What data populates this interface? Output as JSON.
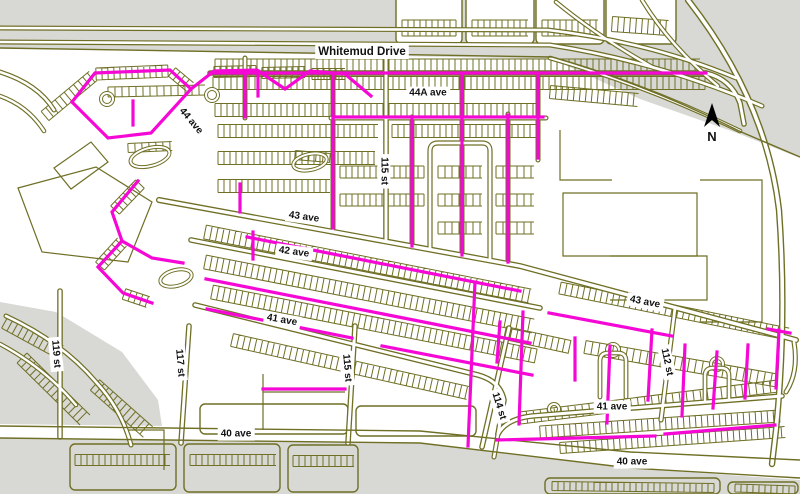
{
  "map": {
    "width": 800,
    "height": 494,
    "colors": {
      "olive": "#6f6f26",
      "magenta": "#f507d5",
      "gray": "#d8d8d4",
      "road_fill": "#ffffff",
      "label_text": "#111111",
      "label_bg": "#ffffff",
      "north": "#000000",
      "background": "#ffffff"
    },
    "gray_areas": [
      "M0,0 L800,0 L800,158 L737,133 L640,99 L552,59 L0,48 Z",
      "M0,302 L56,312 L122,352 L158,400 L162,426 L0,424 Z",
      "M0,438 L420,443 L630,468 L800,480 L800,494 L0,494 Z"
    ],
    "white_blocks": [
      {
        "x": 396,
        "y": -8,
        "w": 66,
        "h": 52
      },
      {
        "x": 466,
        "y": -8,
        "w": 68,
        "h": 52
      },
      {
        "x": 536,
        "y": -8,
        "w": 68,
        "h": 52
      },
      {
        "x": 606,
        "y": -6,
        "w": 70,
        "h": 50
      },
      {
        "x": 200,
        "y": 404,
        "w": 148,
        "h": 30
      },
      {
        "x": 356,
        "y": 406,
        "w": 120,
        "h": 30
      }
    ],
    "gray_blocks": [
      {
        "x": 70,
        "y": 444,
        "w": 106,
        "h": 46
      },
      {
        "x": 184,
        "y": 444,
        "w": 96,
        "h": 48
      },
      {
        "x": 288,
        "y": 445,
        "w": 70,
        "h": 47
      },
      {
        "x": 545,
        "y": 478,
        "w": 175,
        "h": 16
      },
      {
        "x": 728,
        "y": 482,
        "w": 70,
        "h": 12
      }
    ],
    "parcels": [
      "M563,193 L697,193 L697,256 L563,256 Z",
      "M610,256 L707,256 L707,300 L610,300",
      "M700,180 L762,180 L762,322 L700,322",
      "M560,130 L560,180 L612,180",
      "M18,188 L96,167 L152,202 L128,262 L42,252 Z",
      "M54,168 L91,142 L108,162 L71,189 Z",
      "M128,430 L164,430 L164,470",
      "M263,374 L263,430",
      "M263,392 L345,392"
    ],
    "strips": [
      {
        "x1": 215,
        "y1": 65,
        "x2": 700,
        "y2": 65,
        "w": 12,
        "sp": 6
      },
      {
        "x1": 213,
        "y1": 83,
        "x2": 705,
        "y2": 83,
        "w": 13,
        "sp": 6
      },
      {
        "x1": 215,
        "y1": 110,
        "x2": 540,
        "y2": 110,
        "w": 13,
        "sp": 6
      },
      {
        "x1": 550,
        "y1": 92,
        "x2": 638,
        "y2": 100,
        "w": 13,
        "sp": 6
      },
      {
        "x1": 218,
        "y1": 131,
        "x2": 378,
        "y2": 131,
        "w": 13,
        "sp": 6
      },
      {
        "x1": 392,
        "y1": 131,
        "x2": 540,
        "y2": 131,
        "w": 13,
        "sp": 6
      },
      {
        "x1": 218,
        "y1": 158,
        "x2": 375,
        "y2": 158,
        "w": 13,
        "sp": 6
      },
      {
        "x1": 218,
        "y1": 186,
        "x2": 330,
        "y2": 186,
        "w": 13,
        "sp": 6
      },
      {
        "x1": 340,
        "y1": 172,
        "x2": 424,
        "y2": 172,
        "w": 12,
        "sp": 6
      },
      {
        "x1": 340,
        "y1": 200,
        "x2": 424,
        "y2": 200,
        "w": 12,
        "sp": 6
      },
      {
        "x1": 438,
        "y1": 172,
        "x2": 482,
        "y2": 172,
        "w": 12,
        "sp": 7
      },
      {
        "x1": 438,
        "y1": 200,
        "x2": 482,
        "y2": 200,
        "w": 12,
        "sp": 7
      },
      {
        "x1": 438,
        "y1": 228,
        "x2": 482,
        "y2": 228,
        "w": 12,
        "sp": 7
      },
      {
        "x1": 496,
        "y1": 172,
        "x2": 534,
        "y2": 172,
        "w": 12,
        "sp": 7
      },
      {
        "x1": 496,
        "y1": 200,
        "x2": 534,
        "y2": 200,
        "w": 12,
        "sp": 7
      },
      {
        "x1": 496,
        "y1": 228,
        "x2": 534,
        "y2": 228,
        "w": 12,
        "sp": 7
      },
      {
        "x1": 205,
        "y1": 232,
        "x2": 530,
        "y2": 296,
        "w": 14,
        "sp": 6
      },
      {
        "x1": 205,
        "y1": 262,
        "x2": 533,
        "y2": 326,
        "w": 14,
        "sp": 6
      },
      {
        "x1": 212,
        "y1": 292,
        "x2": 536,
        "y2": 356,
        "w": 14,
        "sp": 6
      },
      {
        "x1": 232,
        "y1": 340,
        "x2": 468,
        "y2": 393,
        "w": 13,
        "sp": 6
      },
      {
        "x1": 560,
        "y1": 288,
        "x2": 788,
        "y2": 334,
        "w": 12,
        "sp": 6
      },
      {
        "x1": 505,
        "y1": 333,
        "x2": 570,
        "y2": 347,
        "w": 13,
        "sp": 6
      },
      {
        "x1": 585,
        "y1": 347,
        "x2": 780,
        "y2": 381,
        "w": 13,
        "sp": 7
      },
      {
        "x1": 540,
        "y1": 432,
        "x2": 780,
        "y2": 416,
        "w": 12,
        "sp": 6
      },
      {
        "x1": 560,
        "y1": 448,
        "x2": 785,
        "y2": 432,
        "w": 11,
        "sp": 6
      },
      {
        "x1": 520,
        "y1": 418,
        "x2": 778,
        "y2": 386,
        "w": 12,
        "sp": 7
      },
      {
        "x1": 75,
        "y1": 460,
        "x2": 170,
        "y2": 460,
        "w": 11,
        "sp": 6
      },
      {
        "x1": 190,
        "y1": 460,
        "x2": 276,
        "y2": 460,
        "w": 11,
        "sp": 6
      },
      {
        "x1": 293,
        "y1": 461,
        "x2": 354,
        "y2": 461,
        "w": 11,
        "sp": 6
      },
      {
        "x1": 552,
        "y1": 486,
        "x2": 714,
        "y2": 488,
        "w": 9,
        "sp": 6
      },
      {
        "x1": 735,
        "y1": 488,
        "x2": 795,
        "y2": 490,
        "w": 8,
        "sp": 6
      },
      {
        "x1": 22,
        "y1": 358,
        "x2": 85,
        "y2": 420,
        "w": 14,
        "sp": 6
      },
      {
        "x1": 95,
        "y1": 385,
        "x2": 148,
        "y2": 432,
        "w": 14,
        "sp": 6
      },
      {
        "x1": 5,
        "y1": 322,
        "x2": 60,
        "y2": 352,
        "w": 14,
        "sp": 6
      },
      {
        "x1": 402,
        "y1": 28,
        "x2": 456,
        "y2": 28,
        "w": 16,
        "sp": 6
      },
      {
        "x1": 472,
        "y1": 28,
        "x2": 528,
        "y2": 28,
        "w": 16,
        "sp": 6
      },
      {
        "x1": 542,
        "y1": 28,
        "x2": 598,
        "y2": 28,
        "w": 16,
        "sp": 6
      },
      {
        "x1": 612,
        "y1": 24,
        "x2": 668,
        "y2": 28,
        "w": 15,
        "sp": 6
      },
      {
        "x1": 45,
        "y1": 116,
        "x2": 93,
        "y2": 76,
        "w": 12,
        "sp": 6
      },
      {
        "x1": 96,
        "y1": 74,
        "x2": 168,
        "y2": 71,
        "w": 12,
        "sp": 6
      },
      {
        "x1": 172,
        "y1": 72,
        "x2": 190,
        "y2": 87,
        "w": 11,
        "sp": 6
      },
      {
        "x1": 214,
        "y1": 72,
        "x2": 256,
        "y2": 71,
        "w": 11,
        "sp": 6
      },
      {
        "x1": 262,
        "y1": 73,
        "x2": 305,
        "y2": 72,
        "w": 11,
        "sp": 6
      },
      {
        "x1": 312,
        "y1": 74,
        "x2": 345,
        "y2": 74,
        "w": 11,
        "sp": 6
      },
      {
        "x1": 115,
        "y1": 210,
        "x2": 140,
        "y2": 184,
        "w": 12,
        "sp": 6
      },
      {
        "x1": 100,
        "y1": 266,
        "x2": 122,
        "y2": 242,
        "w": 12,
        "sp": 6
      },
      {
        "x1": 124,
        "y1": 294,
        "x2": 148,
        "y2": 302,
        "w": 11,
        "sp": 6
      },
      {
        "x1": 108,
        "y1": 92,
        "x2": 205,
        "y2": 90,
        "w": 10,
        "sp": 7
      },
      {
        "x1": 128,
        "y1": 148,
        "x2": 172,
        "y2": 146,
        "w": 9,
        "sp": 7
      },
      {
        "x1": 295,
        "y1": 155,
        "x2": 330,
        "y2": 158,
        "w": 9,
        "sp": 7
      }
    ],
    "rings": [
      {
        "cx": 107,
        "cy": 99,
        "r": 6
      },
      {
        "cx": 212,
        "cy": 95,
        "r": 6
      },
      {
        "cx": 613,
        "cy": 350,
        "r": 6
      },
      {
        "cx": 717,
        "cy": 364,
        "r": 6
      },
      {
        "cx": 554,
        "cy": 409,
        "r": 5
      }
    ],
    "ovals": [
      {
        "cx": 150,
        "cy": 157,
        "rx": 20,
        "ry": 9,
        "rot": -15
      },
      {
        "cx": 310,
        "cy": 162,
        "rx": 17,
        "ry": 8,
        "rot": -12
      },
      {
        "cx": 176,
        "cy": 278,
        "rx": 16,
        "ry": 8,
        "rot": -14
      }
    ],
    "roads": [
      {
        "d": "M0,28 L548,30 Q650,42 736,78",
        "w": 5,
        "f": 2.6
      },
      {
        "d": "M0,42 L550,45 Q660,62 762,106",
        "w": 5,
        "f": 2.6
      },
      {
        "d": "M556,2 Q600,38 654,68",
        "w": 4.6,
        "f": 2.4
      },
      {
        "d": "M642,0 Q670,46 718,86",
        "w": 4.6,
        "f": 2.4
      },
      {
        "d": "M688,0 Q766,100 779,210 Q787,320 776,430 L772,464",
        "w": 6.4,
        "f": 3.6
      },
      {
        "d": "M550,58 Q648,86 740,131",
        "w": 4.6,
        "f": 2.4
      },
      {
        "d": "M210,73 L706,73 Q731,79 740,103 L744,124",
        "w": 5.6,
        "f": 3
      },
      {
        "d": "M386,58 L386,239",
        "w": 5.6,
        "f": 3
      },
      {
        "d": "M245,58 L245,118",
        "w": 5,
        "f": 2.6
      },
      {
        "d": "M333,73 L333,229",
        "w": 5,
        "f": 2.6
      },
      {
        "d": "M412,117 L412,247",
        "w": 5,
        "f": 2.6
      },
      {
        "d": "M462,73 L462,256",
        "w": 5,
        "f": 2.6
      },
      {
        "d": "M508,114 L508,263",
        "w": 5,
        "f": 2.6
      },
      {
        "d": "M538,73 L538,160",
        "w": 5,
        "f": 2.6
      },
      {
        "d": "M331,118 L546,118",
        "w": 5,
        "f": 2.6
      },
      {
        "d": "M430,249 L430,151 Q430,143 438,143 L482,143 Q490,143 490,151 L490,259",
        "w": 5.2,
        "f": 2.8
      },
      {
        "d": "M159,200 L520,266 L796,340",
        "w": 6,
        "f": 3.4
      },
      {
        "d": "M794,342 Q799,372 786,392",
        "w": 5,
        "f": 2.6
      },
      {
        "d": "M191,240 L540,308",
        "w": 5.6,
        "f": 3
      },
      {
        "d": "M195,305 L478,375 Q500,381 504,400 L498,434",
        "w": 5.6,
        "f": 3
      },
      {
        "d": "M498,434 Q506,419 532,416 L782,396",
        "w": 5.6,
        "f": 3
      },
      {
        "d": "M60,291 L60,437",
        "w": 5.6,
        "f": 3
      },
      {
        "d": "M189,326 L181,443",
        "w": 5.6,
        "f": 3
      },
      {
        "d": "M355,326 L348,443",
        "w": 5.6,
        "f": 3
      },
      {
        "d": "M509,328 L482,447",
        "w": 5.6,
        "f": 3
      },
      {
        "d": "M675,308 L661,420",
        "w": 5.2,
        "f": 2.8
      },
      {
        "d": "M498,434 L494,457",
        "w": 5,
        "f": 2.6
      },
      {
        "d": "M600,397 L600,361 Q600,353 608,353 L618,353 Q626,353 626,361 L626,397",
        "w": 4.8,
        "f": 2.5
      },
      {
        "d": "M705,400 L705,376 Q705,368 713,368 L721,368 Q729,368 729,376 L729,400",
        "w": 4.8,
        "f": 2.5
      },
      {
        "d": "M0,72 Q38,84 54,110",
        "w": 5,
        "f": 2.6
      },
      {
        "d": "M0,96 Q28,106 44,131",
        "w": 4.6,
        "f": 2.4
      },
      {
        "d": "M6,316 Q62,342 96,382 Q122,410 131,445",
        "w": 5,
        "f": 2.6
      },
      {
        "d": "M0,344 Q45,368 76,405",
        "w": 4.6,
        "f": 2.4
      }
    ],
    "thin_lines": [
      "M0,48 L552,57",
      "M552,57 Q648,85 739,131 L800,157",
      "M0,426 L420,431 L630,452 L800,460",
      "M0,438 L420,443 L630,468 L800,478"
    ],
    "highlights": [
      "M210,73 L706,73",
      "M245,73 L245,117",
      "M333,75 L333,228",
      "M412,117 L412,246",
      "M462,74 L462,255",
      "M508,115 L508,262",
      "M538,74 L538,158",
      "M333,117 L543,117",
      "M72,102 L95,73 L170,70 L191,89 L214,71 L257,70 L285,89 L310,71 L345,74 L371,96",
      "M72,102 L108,138 L151,133 L191,89",
      "M133,101 L133,125",
      "M258,71 L258,96",
      "M138,181 L112,212 L122,241 L98,267 L123,293 L152,303",
      "M122,241 L152,258 L183,263",
      "M247,237 L520,291",
      "M206,279 L530,343",
      "M207,309 L352,338",
      "M382,346 L532,375",
      "M240,184 L240,212",
      "M253,232 L253,259",
      "M475,282 L468,446",
      "M500,322 L497,362",
      "M523,312 L519,424",
      "M549,313 L672,336",
      "M575,338 L575,380",
      "M610,346 L607,423",
      "M652,330 L648,400",
      "M685,345 L682,416",
      "M717,352 L713,408",
      "M748,345 L745,398",
      "M779,330 L776,388",
      "M768,329 L790,333",
      "M497,440 L655,436",
      "M665,434 L775,425",
      "M263,389 L345,389"
    ],
    "labels": [
      {
        "text": "Whitemud Drive",
        "x": 362,
        "y": 52,
        "rot": 0,
        "size": 11.5
      },
      {
        "text": "44A ave",
        "x": 428,
        "y": 93,
        "rot": 0,
        "size": 10
      },
      {
        "text": "44 ave",
        "x": 191,
        "y": 121,
        "rot": 50,
        "size": 10
      },
      {
        "text": "115 st",
        "x": 384,
        "y": 171,
        "rot": 90,
        "size": 10
      },
      {
        "text": "43 ave",
        "x": 304,
        "y": 217,
        "rot": 8,
        "size": 10
      },
      {
        "text": "42 ave",
        "x": 294,
        "y": 252,
        "rot": 8,
        "size": 10
      },
      {
        "text": "41 ave",
        "x": 282,
        "y": 320,
        "rot": 10,
        "size": 10
      },
      {
        "text": "43 ave",
        "x": 645,
        "y": 302,
        "rot": 11,
        "size": 10
      },
      {
        "text": "112 st",
        "x": 667,
        "y": 362,
        "rot": 78,
        "size": 10
      },
      {
        "text": "114 st",
        "x": 499,
        "y": 406,
        "rot": 73,
        "size": 10
      },
      {
        "text": "41 ave",
        "x": 612,
        "y": 407,
        "rot": 0,
        "size": 10
      },
      {
        "text": "40 ave",
        "x": 236,
        "y": 434,
        "rot": 0,
        "size": 10
      },
      {
        "text": "40 ave",
        "x": 632,
        "y": 462,
        "rot": 0,
        "size": 10
      },
      {
        "text": "119 st",
        "x": 56,
        "y": 354,
        "rot": 85,
        "size": 10
      },
      {
        "text": "117 st",
        "x": 180,
        "y": 363,
        "rot": 85,
        "size": 10
      },
      {
        "text": "115 st",
        "x": 347,
        "y": 368,
        "rot": 85,
        "size": 10
      }
    ],
    "north_arrow": {
      "points": "712,103 704,127 712,120 720,127",
      "label": "N",
      "x": 712,
      "y": 141
    }
  }
}
